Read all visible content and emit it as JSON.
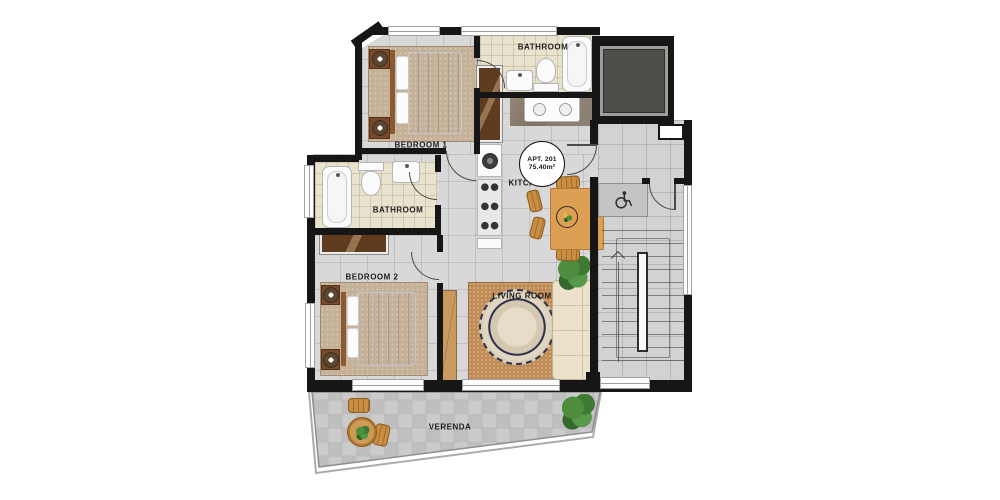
{
  "title": "Apartment 201 floor plan",
  "badge": {
    "line1": "APT. 201",
    "line2": "75.40m²"
  },
  "rooms": {
    "bedroom1": "BEDROOM 1",
    "bathroom_top": "BATHROOM",
    "kitchen": "KITCHEN",
    "bathroom_mid": "BATHROOM",
    "bedroom2": "BEDROOM 2",
    "living_room": "LIVING ROOM",
    "verenda": "VERENDA"
  },
  "colors": {
    "wall": "#161616",
    "floor": "#d8d8d8",
    "floor_hall": "#d2d2d2",
    "bath_floor": "#e9e2cd",
    "rug_bedroom": "#c5b098",
    "rug_living": "#c08b55",
    "wood_dark": "#5f3c20",
    "wood_light": "#c89a62",
    "sofa": "#ece2cc",
    "table_wood": "#dd9f54",
    "plant_green": "#47823a",
    "elevator": "#4e4e4b",
    "ink": "#1d1d1d"
  }
}
